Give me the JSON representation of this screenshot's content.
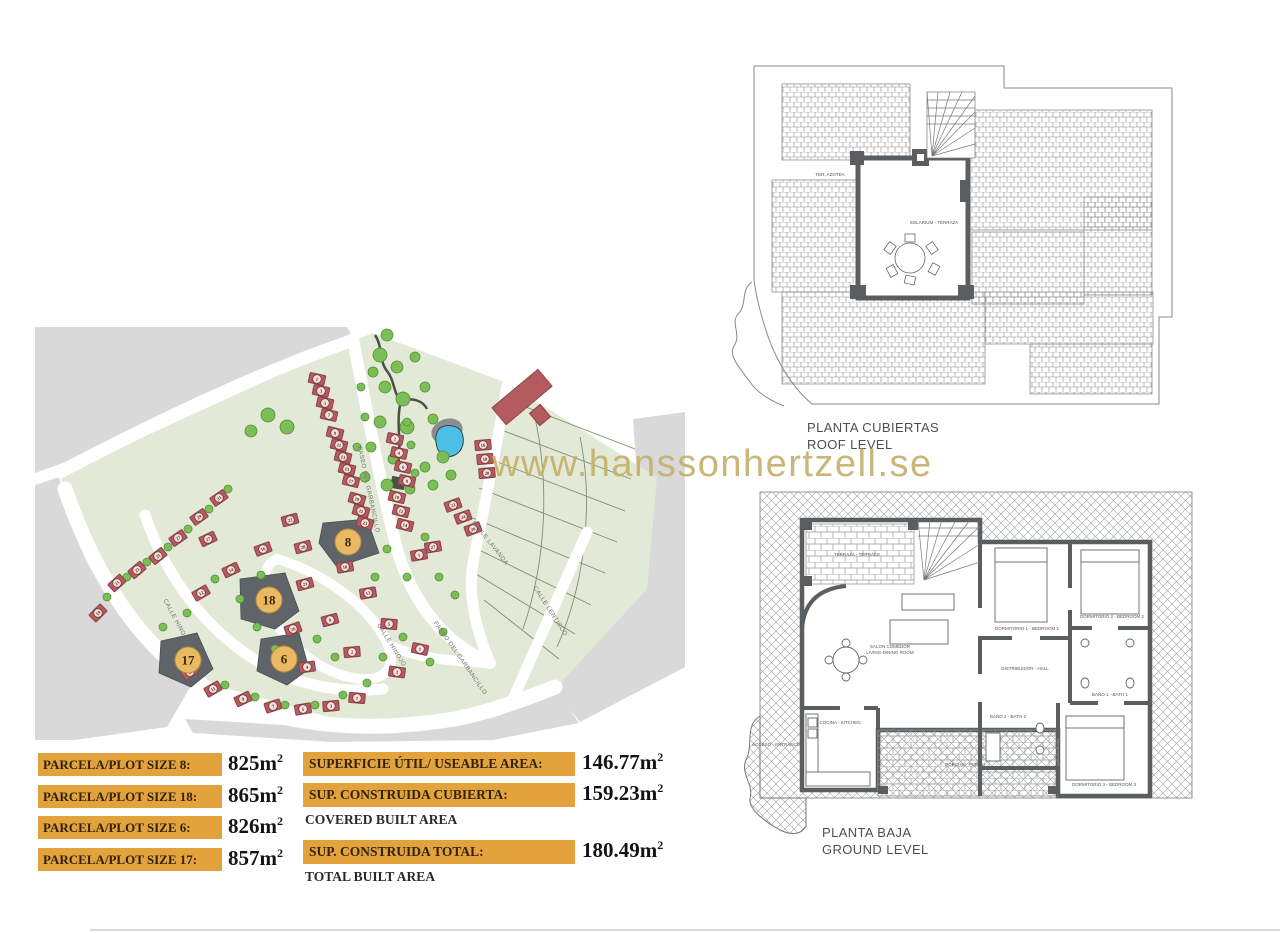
{
  "watermark": "www.hanssonhertzell.se",
  "colors": {
    "accent_orange": "#E2A23C",
    "watermark_gold": "#C6B06A",
    "house_red": "#B35B5F",
    "site_green": "#E2E9D7",
    "gray_land": "#D9D9D9",
    "plot_dark": "#5E6468",
    "plot_gold": "#EAB964",
    "tree_green": "#7CBE56",
    "pool_blue": "#4CC0E4"
  },
  "roof_plan": {
    "caption_line1": "PLANTA CUBIERTAS",
    "caption_line2": "ROOF LEVEL",
    "terrace_label": "TER. AZOTEA",
    "solarium_label": "SOLARIUM - TERRAZA"
  },
  "ground_plan": {
    "caption_line1": "PLANTA BAJA",
    "caption_line2": "GROUND LEVEL",
    "rooms": [
      {
        "t": "TERRAZA - TERRACE",
        "x": 117,
        "y": 78
      },
      {
        "t": "SALON COMEDOR",
        "x": 150,
        "y": 170
      },
      {
        "t": "LIVING-DINING ROOM",
        "x": 150,
        "y": 176
      },
      {
        "t": "COCINA - KITCHEN",
        "x": 100,
        "y": 246
      },
      {
        "t": "PORCHE - PORCH",
        "x": 225,
        "y": 288
      },
      {
        "t": "DORMITORIO 1 - BEDROOM 1",
        "x": 287,
        "y": 152
      },
      {
        "t": "DORMITORIO 2 - BEDROOM 2",
        "x": 372,
        "y": 140
      },
      {
        "t": "DORMITORIO 3 - BEDROOM 3",
        "x": 364,
        "y": 308
      },
      {
        "t": "BAÑO 1 - BATH 1",
        "x": 370,
        "y": 218
      },
      {
        "t": "BAÑO 2 - BATH 2",
        "x": 268,
        "y": 240
      },
      {
        "t": "DISTRIBUIDOR - HALL",
        "x": 285,
        "y": 192
      },
      {
        "t": "ACCESO - ENTRANCE",
        "x": 36,
        "y": 268
      }
    ]
  },
  "site_plan": {
    "streets": [
      {
        "name": "PASEO DEL GARBANCILLO",
        "x": 332,
        "y": 163,
        "rot": 78
      },
      {
        "name": "CALLE LAVANDA",
        "x": 454,
        "y": 217,
        "rot": 52
      },
      {
        "name": "CALLE LENTISCO",
        "x": 514,
        "y": 285,
        "rot": 57
      },
      {
        "name": "CALLE HINOJO",
        "x": 140,
        "y": 295,
        "rot": 62
      },
      {
        "name": "CALLE HINOJO",
        "x": 355,
        "y": 319,
        "rot": 58
      },
      {
        "name": "PASEO DEL GARBANCILLO",
        "x": 424,
        "y": 332,
        "rot": 55
      }
    ],
    "plots": [
      {
        "num": "8",
        "cx": 313,
        "cy": 215
      },
      {
        "num": "18",
        "cx": 234,
        "cy": 273
      },
      {
        "num": "6",
        "cx": 249,
        "cy": 332
      },
      {
        "num": "17",
        "cx": 153,
        "cy": 333
      }
    ],
    "houses": [
      [
        282,
        52,
        12,
        "1"
      ],
      [
        286,
        64,
        12,
        "3"
      ],
      [
        290,
        76,
        12,
        "5"
      ],
      [
        294,
        88,
        12,
        "7"
      ],
      [
        300,
        106,
        14,
        "9"
      ],
      [
        304,
        118,
        14,
        "11"
      ],
      [
        308,
        130,
        14,
        "13"
      ],
      [
        312,
        142,
        14,
        "15"
      ],
      [
        316,
        154,
        14,
        "17"
      ],
      [
        322,
        172,
        16,
        "19"
      ],
      [
        326,
        184,
        16,
        "21"
      ],
      [
        330,
        196,
        16,
        "23"
      ],
      [
        360,
        112,
        12,
        "2"
      ],
      [
        364,
        126,
        12,
        "4"
      ],
      [
        368,
        140,
        12,
        "6"
      ],
      [
        372,
        154,
        12,
        "8"
      ],
      [
        362,
        170,
        14,
        "10"
      ],
      [
        366,
        184,
        14,
        "12"
      ],
      [
        370,
        198,
        14,
        "14"
      ],
      [
        448,
        118,
        -5,
        "16"
      ],
      [
        450,
        132,
        -5,
        "18"
      ],
      [
        452,
        146,
        -5,
        "20"
      ],
      [
        418,
        178,
        -20,
        "22"
      ],
      [
        428,
        190,
        -20,
        "24"
      ],
      [
        438,
        202,
        -20,
        "26"
      ],
      [
        398,
        220,
        -10,
        "27"
      ],
      [
        384,
        228,
        -10,
        "1"
      ],
      [
        184,
        171,
        -35,
        "31"
      ],
      [
        164,
        190,
        -35,
        "29"
      ],
      [
        143,
        211,
        -35,
        "27"
      ],
      [
        123,
        229,
        -38,
        "25"
      ],
      [
        102,
        243,
        -40,
        "23"
      ],
      [
        82,
        256,
        -42,
        "21"
      ],
      [
        63,
        286,
        -45,
        "19"
      ],
      [
        173,
        212,
        -25,
        "27"
      ],
      [
        228,
        222,
        -20,
        "16"
      ],
      [
        196,
        243,
        -25,
        "14"
      ],
      [
        166,
        266,
        -30,
        "12"
      ],
      [
        268,
        220,
        -15,
        "28"
      ],
      [
        310,
        240,
        -10,
        "10"
      ],
      [
        270,
        257,
        -15,
        "21"
      ],
      [
        333,
        266,
        -10,
        "13"
      ],
      [
        255,
        193,
        -15,
        "22"
      ],
      [
        258,
        302,
        -20,
        "26"
      ],
      [
        295,
        293,
        -15,
        "9"
      ],
      [
        317,
        325,
        -5,
        "2"
      ],
      [
        272,
        340,
        -8,
        "4"
      ],
      [
        155,
        345,
        -35,
        "13"
      ],
      [
        178,
        362,
        -30,
        "11"
      ],
      [
        208,
        372,
        -25,
        "9"
      ],
      [
        238,
        379,
        -18,
        "7"
      ],
      [
        268,
        382,
        -10,
        "5"
      ],
      [
        296,
        379,
        -5,
        "3"
      ],
      [
        322,
        371,
        5,
        "1"
      ],
      [
        385,
        322,
        12,
        "1"
      ],
      [
        362,
        345,
        8,
        "3"
      ],
      [
        354,
        297,
        5,
        "5"
      ]
    ],
    "trees": [
      [
        345,
        28,
        7
      ],
      [
        362,
        40,
        6
      ],
      [
        380,
        30,
        5
      ],
      [
        350,
        60,
        6
      ],
      [
        368,
        72,
        7
      ],
      [
        390,
        60,
        5
      ],
      [
        345,
        95,
        6
      ],
      [
        372,
        100,
        7
      ],
      [
        398,
        92,
        5
      ],
      [
        408,
        130,
        6
      ],
      [
        390,
        140,
        5
      ],
      [
        358,
        132,
        5
      ],
      [
        336,
        120,
        5
      ],
      [
        330,
        150,
        5
      ],
      [
        352,
        158,
        6
      ],
      [
        375,
        162,
        5
      ],
      [
        398,
        158,
        5
      ],
      [
        416,
        148,
        5
      ],
      [
        352,
        8,
        6
      ],
      [
        338,
        45,
        5
      ],
      [
        233,
        88,
        7
      ],
      [
        252,
        100,
        7
      ],
      [
        216,
        104,
        6
      ],
      [
        72,
        270,
        4
      ],
      [
        92,
        250,
        4
      ],
      [
        112,
        235,
        4
      ],
      [
        133,
        220,
        4
      ],
      [
        153,
        202,
        4
      ],
      [
        174,
        182,
        4
      ],
      [
        193,
        162,
        4
      ],
      [
        180,
        252,
        4
      ],
      [
        205,
        272,
        4
      ],
      [
        152,
        286,
        4
      ],
      [
        128,
        300,
        4
      ],
      [
        226,
        248,
        4
      ],
      [
        282,
        312,
        4
      ],
      [
        240,
        322,
        4
      ],
      [
        300,
        330,
        4
      ],
      [
        222,
        300,
        4
      ],
      [
        160,
        340,
        4
      ],
      [
        190,
        358,
        4
      ],
      [
        220,
        370,
        4
      ],
      [
        250,
        378,
        4
      ],
      [
        280,
        378,
        4
      ],
      [
        308,
        368,
        4
      ],
      [
        332,
        356,
        4
      ],
      [
        368,
        310,
        4
      ],
      [
        348,
        330,
        4
      ],
      [
        395,
        335,
        4
      ],
      [
        408,
        305,
        4
      ],
      [
        372,
        250,
        4
      ],
      [
        340,
        250,
        4
      ],
      [
        390,
        210,
        4
      ],
      [
        352,
        222,
        4
      ],
      [
        404,
        250,
        4
      ],
      [
        420,
        268,
        4
      ],
      [
        326,
        60,
        4
      ],
      [
        330,
        90,
        4
      ],
      [
        322,
        120,
        4
      ],
      [
        376,
        118,
        4
      ],
      [
        380,
        146,
        4
      ],
      [
        372,
        95,
        4
      ]
    ]
  },
  "table": {
    "unit": "m",
    "sup": "2",
    "plot_rows": [
      {
        "label": "PARCELA/PLOT SIZE 8:",
        "value": "825"
      },
      {
        "label": "PARCELA/PLOT SIZE 18:",
        "value": "865"
      },
      {
        "label": "PARCELA/PLOT SIZE 6:",
        "value": "826"
      },
      {
        "label": "PARCELA/PLOT SIZE 17:",
        "value": "857"
      }
    ],
    "area_rows": [
      {
        "label": "SUPERFICIE ÚTIL/ USEABLE AREA:",
        "value": "146.77",
        "sub": ""
      },
      {
        "label": "SUP. CONSTRUIDA CUBIERTA:",
        "value": "159.23",
        "sub": "COVERED BUILT AREA"
      },
      {
        "label": "SUP. CONSTRUIDA TOTAL:",
        "value": "180.49",
        "sub": "TOTAL BUILT AREA"
      }
    ]
  }
}
